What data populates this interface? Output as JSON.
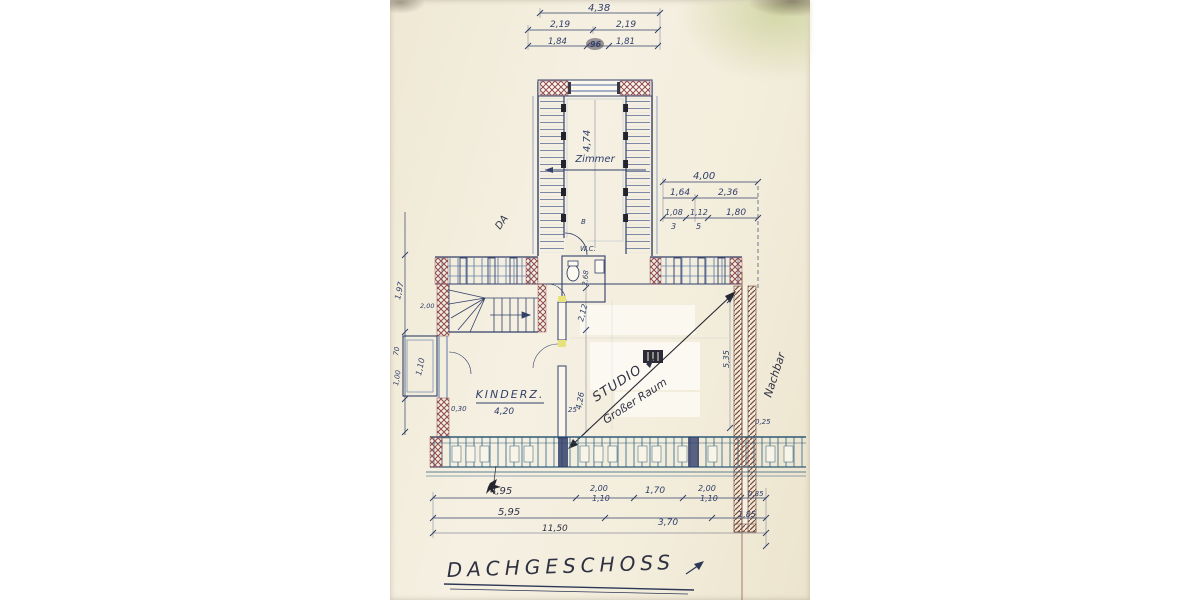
{
  "plan": {
    "title": "DACHGESCHOSS",
    "rooms": {
      "zimmer": "Zimmer",
      "wc": "W.C.",
      "kinder": "KINDERZ.",
      "studio": "STUDIO",
      "studio_alt": "Großer Raum"
    },
    "notes": {
      "neighbor": "Nachbar",
      "section_mark": "DA",
      "door_mark": "B"
    },
    "dims": {
      "top": {
        "total": "4,38",
        "a": "2,19",
        "b": "2,19",
        "c": "1,84",
        "d": "96",
        "e": "1,81"
      },
      "wing": {
        "depth": "4,74"
      },
      "upper_right": {
        "total": "4,00",
        "a": "1,64",
        "b": "2,36",
        "c": "1,08",
        "c_den": "3",
        "d": "1,12",
        "d_den": "5",
        "e": "1,80"
      },
      "left": {
        "a": "1,97",
        "b": "70",
        "c": "1,00",
        "d": "2,00"
      },
      "balcony": "1,10",
      "wc": "2,68",
      "kinder": {
        "wall": "0,30",
        "width": "4,20",
        "jamb": "25"
      },
      "studio": {
        "a": "2,12",
        "b": "4,26"
      },
      "party": {
        "depth": "5,35",
        "offset": "0,25"
      },
      "bottom": {
        "r1": [
          "4,95",
          "2,00",
          "1,70",
          "2,00",
          "0,85"
        ],
        "windows": [
          "1,10",
          "1,10"
        ],
        "r2": [
          "5,95",
          "3,70",
          "1,85"
        ],
        "total": "11,50"
      }
    }
  }
}
